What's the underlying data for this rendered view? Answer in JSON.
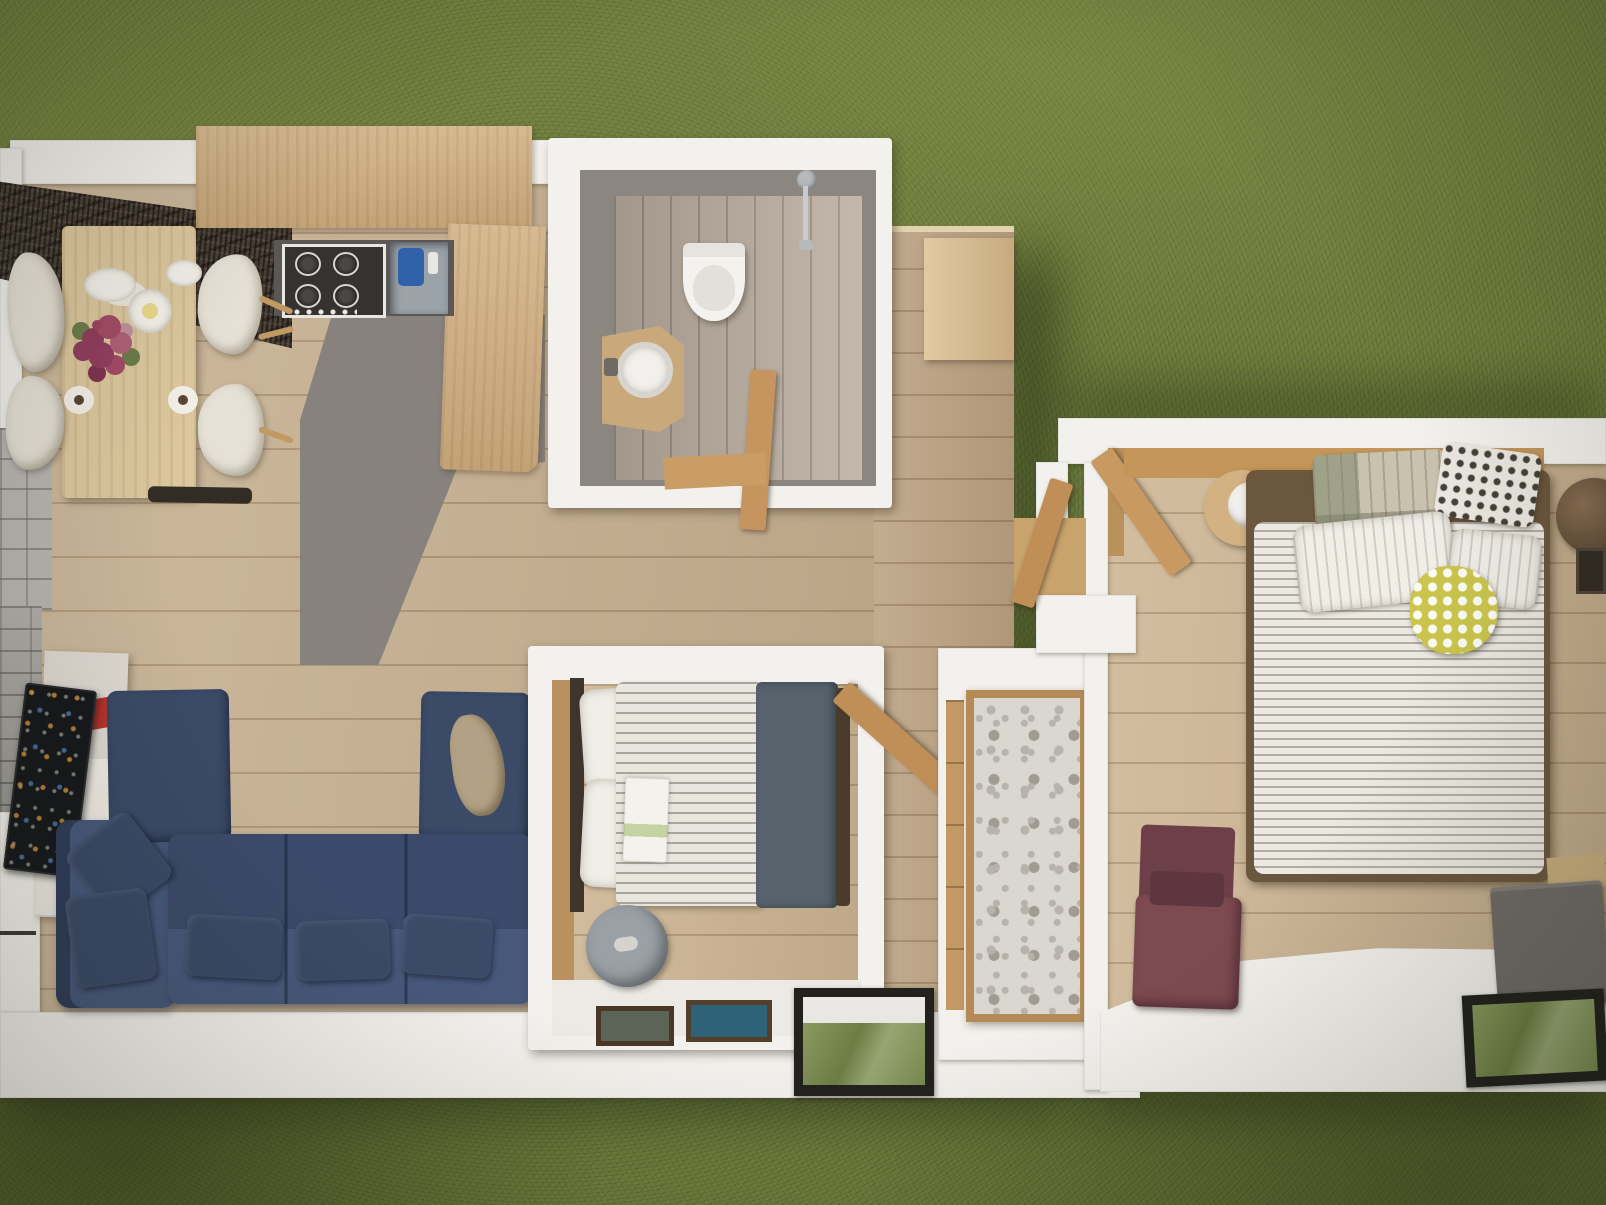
{
  "scene": {
    "type": "3d-floor-plan-render",
    "view": "top-down",
    "setting": "grass-lawn",
    "units": [
      {
        "name": "main-unit",
        "rooms": [
          {
            "name": "kitchen-dining",
            "items": [
              "dining-table",
              "dining-chair",
              "dining-chair",
              "dining-chair",
              "dining-chair",
              "plate-stack",
              "small-plate",
              "candle-plate",
              "flower-vase",
              "coffee-cup",
              "coffee-cup",
              "kitchen-counter",
              "gas-hob",
              "kitchen-sink",
              "stone-accent-wall",
              "entry-tiles"
            ]
          },
          {
            "name": "bathroom",
            "items": [
              "toilet",
              "washbasin-vanity",
              "shower",
              "bathroom-door",
              "tiled-floor"
            ]
          },
          {
            "name": "living-room",
            "items": [
              "sectional-sofa",
              "throw-pillow",
              "throw-pillow",
              "throw-pillow",
              "throw-pillow",
              "throw-pillow",
              "throw-blanket",
              "tv",
              "media-unit",
              "red-shelf",
              "stone-wall"
            ]
          },
          {
            "name": "small-bedroom",
            "items": [
              "single-bed",
              "pillow",
              "pillow",
              "striped-duvet",
              "slate-blanket",
              "open-magazine",
              "pouf",
              "picture-frame",
              "picture-frame",
              "bedroom-door"
            ]
          },
          {
            "name": "hallway-deck",
            "items": [
              "damask-wardrobe",
              "side-cabinet",
              "wall-window"
            ]
          }
        ]
      },
      {
        "name": "bedroom-unit",
        "rooms": [
          {
            "name": "master-bedroom",
            "items": [
              "double-bed",
              "striped-duvet",
              "patchwork-pillow",
              "polka-dot-pillow",
              "white-pillow",
              "white-pillow",
              "yellow-round-pillow",
              "bedside-table",
              "candle-lamp",
              "dark-bedside-table",
              "maroon-armchair",
              "gray-bench",
              "floor-window",
              "entry-door"
            ]
          }
        ]
      }
    ],
    "colors": {
      "grass": "#6f7e3c",
      "wallWhite": "#f3f1ed",
      "woodFloor": "#c9b394",
      "deckWood": "#bfa788",
      "bedroomFloor": "#cfb897",
      "counterTan": "#d3b285",
      "tableWood": "#dcc79e",
      "accentDark": "#493e35",
      "kitchenFloorGray": "#87827d",
      "bathFloor": "#b9ac9e",
      "bathWall": "#8b8780",
      "sofaBlue": "#47587b",
      "sofaBlueDark": "#3a4a67",
      "tvBlack": "#16181c",
      "accentRed": "#b5332c",
      "stoneGray": "#a9a6a1",
      "tileGray": "#b9b6b1",
      "duvetLight": "#e9e5df",
      "duvetStripe": "#aaa59c",
      "slateBlanket": "#57626d",
      "maroon": "#7e4a52",
      "maroonDark": "#6d3f48",
      "yellowPillow": "#cbc54d",
      "damask": "#dad6d0",
      "damaskPattern": "#b7b2ac",
      "frameWood": "#b58a55",
      "poufGray": "#9aa0a5",
      "windowFrame": "#22211e",
      "windowGlass": "#78894d",
      "benchGray": "#6f6a66",
      "headboardTan": "#c49659",
      "doorWood": "#c08f58",
      "cream": "#e6e1d6",
      "steel": "#9ba3a9",
      "blueJug": "#2f62a8",
      "darkWoodBar": "#3e352c"
    }
  }
}
